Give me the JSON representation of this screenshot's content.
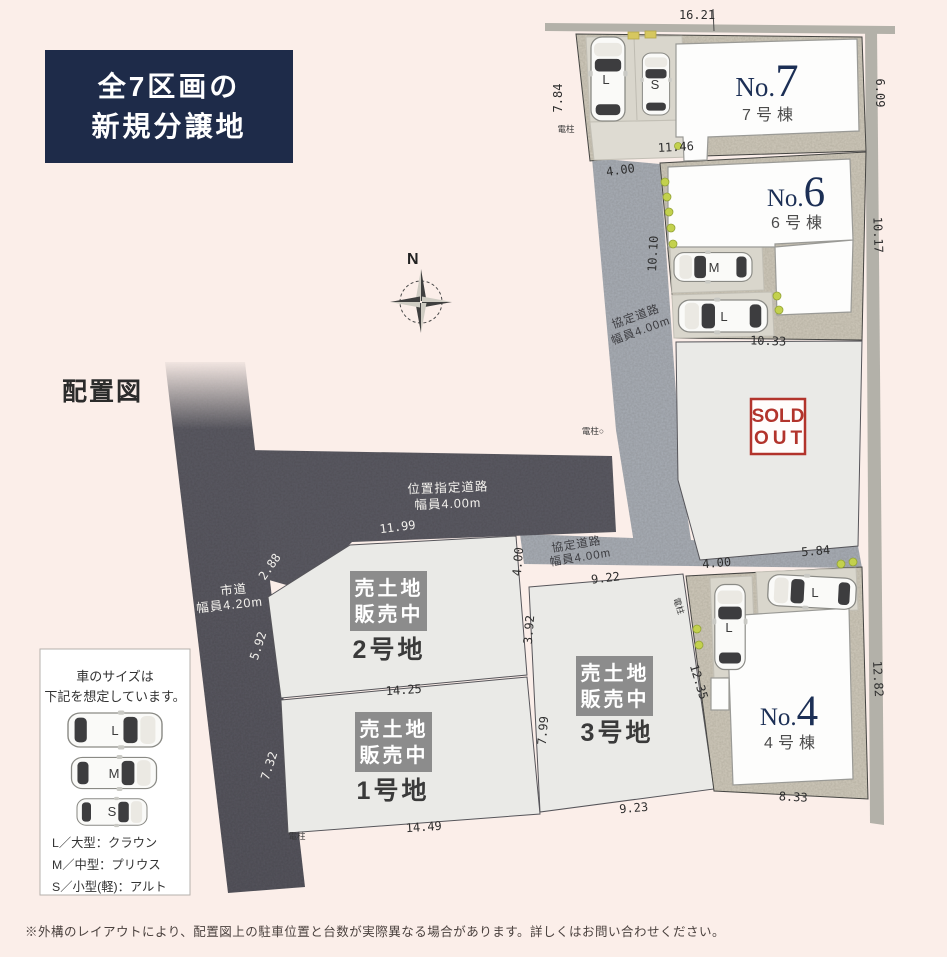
{
  "title_box": {
    "line1": "全7区画の",
    "line2": "新規分譲地"
  },
  "caption": "配置図",
  "compass": {
    "north": "N"
  },
  "footnote": "※外構のレイアウトにより、配置図上の駐車位置と台数が実際異なる場合があります。詳しくはお問い合わせください。",
  "colors": {
    "accent_navy": "#1e2b49",
    "sold_red": "#b2342c",
    "road_dark": "#5b5a63",
    "road_light": "#a9aeb6",
    "lot_beige": "#cfc9bb",
    "lot_gray": "#eaeae7"
  },
  "roads": {
    "shido": {
      "name": "市道",
      "width": "幅員4.20m"
    },
    "ichishitei": {
      "name": "位置指定道路",
      "width": "幅員4.00m"
    },
    "kyotei1": {
      "name": "協定道路",
      "width": "幅員4.00m"
    },
    "kyotei2": {
      "name": "協定道路",
      "width": "幅員4.00m"
    }
  },
  "houses": {
    "no7": {
      "prefix": "No.",
      "number": "7",
      "label": "7号棟"
    },
    "no6": {
      "prefix": "No.",
      "number": "6",
      "label": "6号棟"
    },
    "no4": {
      "prefix": "No.",
      "number": "4",
      "label": "4号棟"
    }
  },
  "land_lots": {
    "lot1": {
      "badge1": "売土地",
      "badge2": "販売中",
      "label": "1号地"
    },
    "lot2": {
      "badge1": "売土地",
      "badge2": "販売中",
      "label": "2号地"
    },
    "lot3": {
      "badge1": "売土地",
      "badge2": "販売中",
      "label": "3号地"
    }
  },
  "sold": {
    "line1": "SOLD",
    "line2": "OUT"
  },
  "cars": {
    "l": "L",
    "m": "M",
    "s": "S"
  },
  "legend": {
    "header1": "車のサイズは",
    "header2": "下記を想定しています。",
    "rows": [
      {
        "label": "L",
        "desc": "L／大型：クラウン"
      },
      {
        "label": "M",
        "desc": "M／中型：プリウス"
      },
      {
        "label": "S",
        "desc": "S／小型(軽)：アルト"
      }
    ]
  },
  "poles": {
    "p1": "電柱",
    "p2": "電柱○",
    "p3": "電柱",
    "p4": "電柱"
  },
  "dims": {
    "d16_21": "16.21",
    "d7_84": "7.84",
    "d6_09": "6.09",
    "d4_00a": "4.00",
    "d11_46": "11.46",
    "d10_10": "10.10",
    "d10_17": "10.17",
    "d10_33": "10.33",
    "d5_84": "5.84",
    "d4_00b": "4.00",
    "d12_82": "12.82",
    "d8_33": "8.33",
    "d9_23": "9.23",
    "d12_35": "12.35",
    "d7_99": "7.99",
    "d3_92": "3.92",
    "d14_25": "14.25",
    "d14_49": "14.49",
    "d9_22": "9.22",
    "d4_00c": "4.00",
    "d2_88": "2.88",
    "d5_92": "5.92",
    "d7_32": "7.32",
    "d11_99": "11.99"
  }
}
